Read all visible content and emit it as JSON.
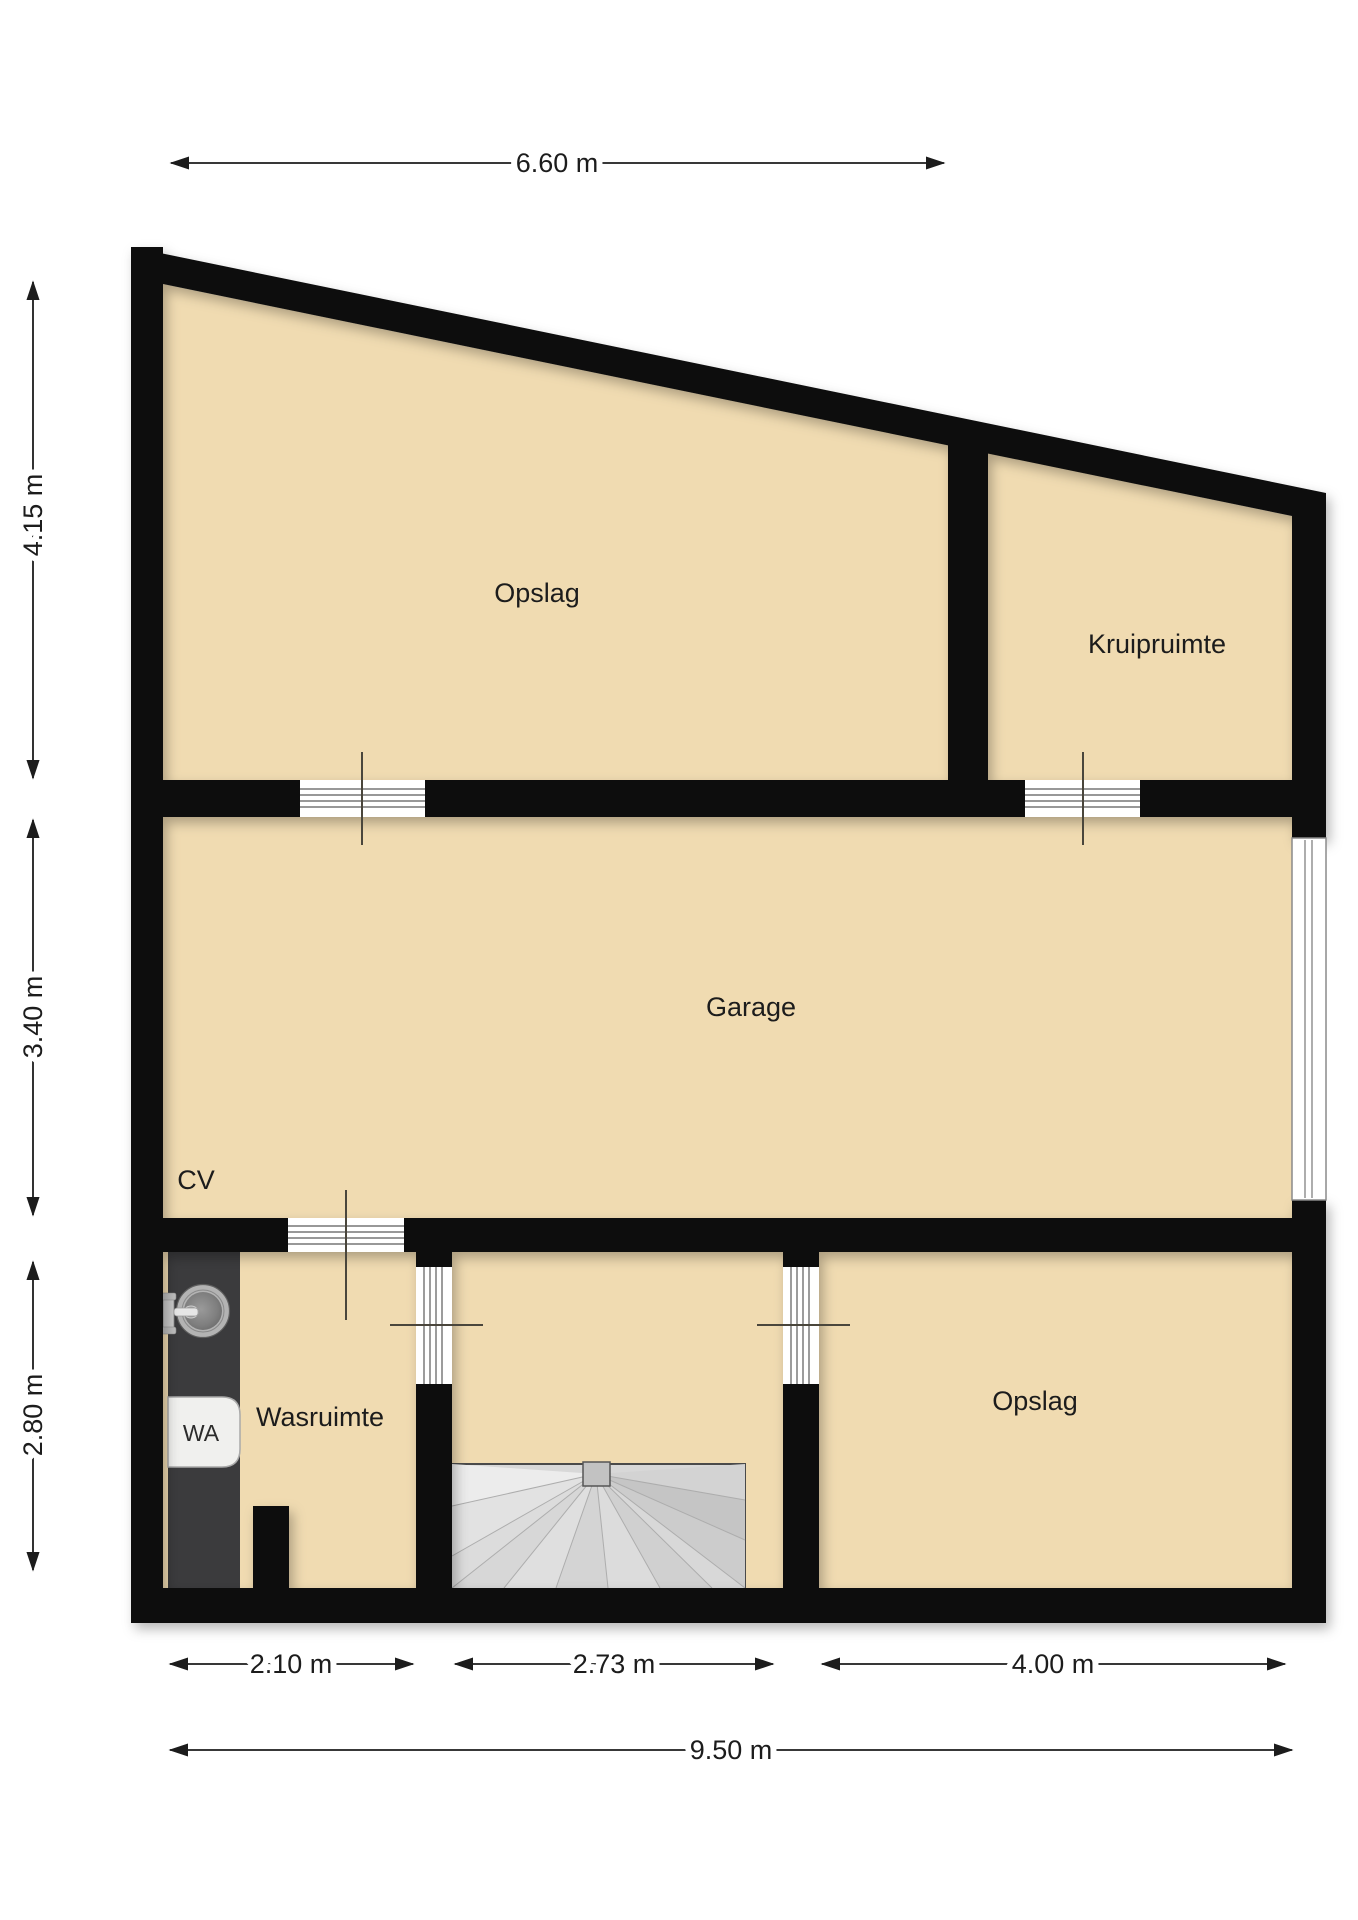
{
  "plan": {
    "type": "floorplan",
    "rooms": [
      {
        "id": "opslag-top",
        "label": "Opslag"
      },
      {
        "id": "kruipruimte",
        "label": "Kruipruimte"
      },
      {
        "id": "garage",
        "label": "Garage"
      },
      {
        "id": "cv",
        "label": "CV"
      },
      {
        "id": "wasruimte",
        "label": "Wasruimte"
      },
      {
        "id": "opslag-bottom",
        "label": "Opslag"
      },
      {
        "id": "washer",
        "label": "WA"
      }
    ],
    "dimensions": {
      "top_width": "6.60 m",
      "left_top": "4.15 m",
      "left_middle": "3.40 m",
      "left_bottom": "2.80 m",
      "bottom_left": "2.10 m",
      "bottom_middle": "2.73 m",
      "bottom_right": "4.00 m",
      "bottom_total": "9.50 m"
    },
    "colors": {
      "wall": "#0f0f0f",
      "floor": "#f0dbb1",
      "counter": "#3b3b3d",
      "stairs": "#d8d8d8",
      "background": "#ffffff"
    }
  }
}
